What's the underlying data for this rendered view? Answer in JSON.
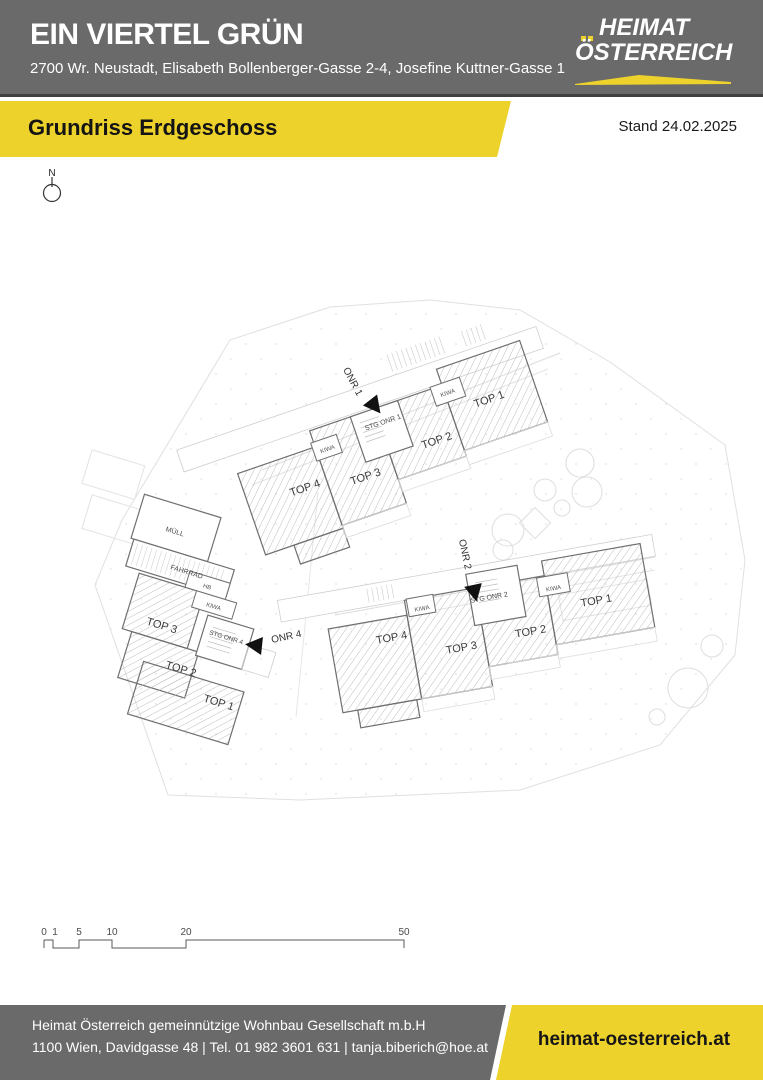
{
  "header": {
    "title": "EIN VIERTEL GRÜN",
    "address": "2700 Wr. Neustadt, Elisabeth Bollenberger-Gasse 2-4, Josefine Kuttner-Gasse 1",
    "logo": {
      "line1": "HEIMAT",
      "line2": "ÖSTERREICH"
    }
  },
  "ribbon": {
    "title": "Grundriss Erdgeschoss",
    "date_label": "Stand 24.02.2025"
  },
  "plan": {
    "north_label": "N",
    "buildings": [
      {
        "entrance_label": "ONR 1",
        "stair_label": "STG ONR 1",
        "units": [
          "TOP 1",
          "TOP 2",
          "TOP 3",
          "TOP 4"
        ],
        "rooms": [
          "KIWA",
          "KIWA"
        ]
      },
      {
        "entrance_label": "ONR 2",
        "stair_label": "STG ONR 2",
        "units": [
          "TOP 1",
          "TOP 2",
          "TOP 3",
          "TOP 4"
        ],
        "rooms": [
          "KIWA",
          "KIWA"
        ]
      },
      {
        "entrance_label": "ONR 4",
        "stair_label": "STG ONR 4",
        "units": [
          "TOP 1",
          "TOP 2",
          "TOP 3"
        ],
        "rooms": [
          "MÜLL",
          "FAHRRAD",
          "HB",
          "KIWA"
        ]
      }
    ],
    "scale_labels": [
      "0",
      "1",
      "5",
      "10",
      "20",
      "50"
    ]
  },
  "footer": {
    "company": "Heimat Österreich gemeinnützige Wohnbau Gesellschaft m.b.H",
    "contact": "1100 Wien, Davidgasse 48 | Tel. 01 982 3601 631 | tanja.biberich@hoe.at",
    "website": "heimat-oesterreich.at"
  },
  "colors": {
    "brand_yellow": "#edd22b",
    "band_gray": "#6a6a6a",
    "text_dark": "#1a1a1a",
    "wall_gray": "#6f6f6f"
  }
}
